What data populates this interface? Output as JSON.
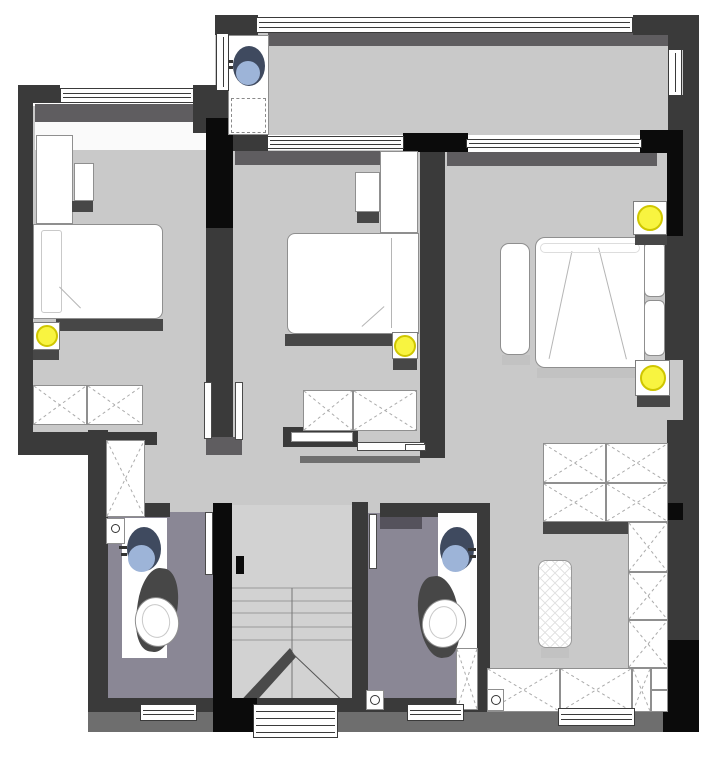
{
  "meta": {
    "type": "architectural-floor-plan",
    "description": "Top-down apartment floor plan with three bedrooms, two bathrooms, balcony, dressing area and staircase; no text labels visible"
  },
  "colors": {
    "wall": "#3a3a3a",
    "wall_black": "#0b0b0b",
    "wall_shadow": "#5f5d60",
    "floor": "#c9c9c9",
    "floor_light": "#d2d2d2",
    "floor_white": "#fafafa",
    "bath_floor": "#8a8795",
    "bath_shadow": "#55525c",
    "bottom_strip": "#6e6e6e",
    "furniture_border": "#8f8f8f",
    "shadow": "#474747",
    "soft_shadow": "#c2c2c2",
    "lamp_yellow": "#f8f440",
    "lamp_ring": "#cfc600",
    "basin_dark": "#3f4a5f",
    "basin_blue": "#9db4d8",
    "line": "#ababab",
    "white": "#ffffff"
  },
  "rooms": [
    {
      "name": "balcony",
      "floor": "gray"
    },
    {
      "name": "bedroom-1",
      "floor": "gray"
    },
    {
      "name": "bedroom-2",
      "floor": "gray"
    },
    {
      "name": "master-bedroom",
      "floor": "gray"
    },
    {
      "name": "hallway",
      "floor": "gray"
    },
    {
      "name": "bathroom-1",
      "floor": "purple-gray"
    },
    {
      "name": "bathroom-2",
      "floor": "purple-gray"
    },
    {
      "name": "staircase",
      "floor": "light-gray"
    },
    {
      "name": "dressing-area",
      "floor": "gray"
    }
  ],
  "fixtures": {
    "ceiling_lamps": 4,
    "wash_basins": 3,
    "toilets": 2,
    "beds": 3,
    "wardrobe_units": 12,
    "staircases": 1,
    "ottomans": 1,
    "benches": 1,
    "windows": 10,
    "door_leaves": 5
  }
}
